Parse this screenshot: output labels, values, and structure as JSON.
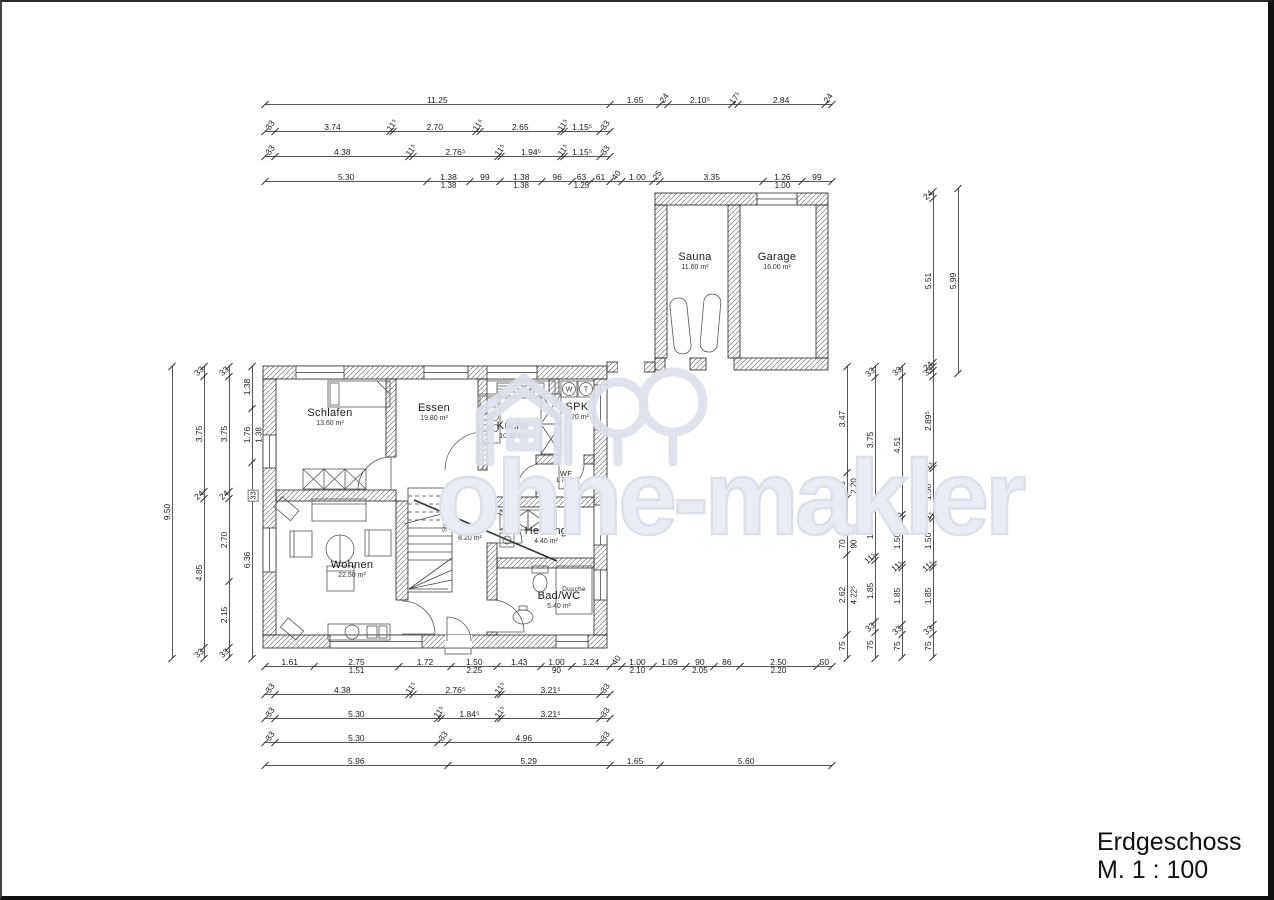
{
  "title": {
    "floor": "Erdgeschoss",
    "scale": "M. 1 : 100"
  },
  "watermark": {
    "text": "ohne-makler"
  },
  "plan": {
    "washer": "W",
    "dryer": "T",
    "stair_note": "Stg.",
    "wall_note": "33"
  },
  "colors": {
    "line": "#333333",
    "dim": "#1c1c1c",
    "watermark": "#e9ecf2"
  },
  "rooms": [
    {
      "name": "Sauna",
      "area": "11.60 m²"
    },
    {
      "name": "Garage",
      "area": "16.00 m²"
    },
    {
      "name": "Schlafen",
      "area": "13.60 m²"
    },
    {
      "name": "Essen",
      "area": "19.80 m²"
    },
    {
      "name": "Küche",
      "area": "10.90 m²"
    },
    {
      "name": "SPK",
      "area": "3.20 m²"
    },
    {
      "name": "WF",
      "area": "1.70 m²"
    },
    {
      "name": "Flur",
      "area": "8.20 m²"
    },
    {
      "name": "Wohnen",
      "area": "22.50 m²"
    },
    {
      "name": "Heizung",
      "area": "4.40 m²"
    },
    {
      "name": "Bad/WC",
      "area": "5.40 m²"
    },
    {
      "name": "Dusche",
      "area": ""
    }
  ],
  "dims": {
    "top": [
      [
        {
          "v": "11.25"
        },
        {
          "v": "1.65"
        },
        {
          "v": "24"
        },
        {
          "v": "2.10⁵"
        },
        {
          "v": "17⁵"
        },
        {
          "v": "2.84"
        },
        {
          "v": "24"
        }
      ],
      [
        {
          "v": "33"
        },
        {
          "v": "3.74"
        },
        {
          "v": "11⁵"
        },
        {
          "v": "2.70"
        },
        {
          "v": "11⁵"
        },
        {
          "v": "2.65"
        },
        {
          "v": "11⁵"
        },
        {
          "v": "1.15⁵"
        },
        {
          "v": "33"
        }
      ],
      [
        {
          "v": "33"
        },
        {
          "v": "4.38"
        },
        {
          "v": "11⁵"
        },
        {
          "v": "2.76⁵"
        },
        {
          "v": "11⁵"
        },
        {
          "v": "1.94⁵"
        },
        {
          "v": "11⁵"
        },
        {
          "v": "1.15⁵"
        },
        {
          "v": "33"
        }
      ],
      [
        {
          "v": "5.30"
        },
        {
          "v": "1.38",
          "sub": "1.38"
        },
        {
          "v": "99"
        },
        {
          "v": "1.38",
          "sub": "1.38"
        },
        {
          "v": "96"
        },
        {
          "v": "63",
          "sub": "1.25"
        },
        {
          "v": "61"
        },
        {
          "v": "40"
        },
        {
          "v": "1.00"
        },
        {
          "v": "25"
        },
        {
          "v": "3.35"
        },
        {
          "v": "1.26",
          "sub": "1.00"
        },
        {
          "v": "99"
        }
      ]
    ],
    "bottom": [
      [
        {
          "v": "1.61"
        },
        {
          "v": "2.75",
          "sub": "1.51"
        },
        {
          "v": "1.72"
        },
        {
          "v": "1.50",
          "sub": "2.25"
        },
        {
          "v": "1.43"
        },
        {
          "v": "1.00",
          "sub": "90"
        },
        {
          "v": "1.24"
        },
        {
          "v": "40"
        },
        {
          "v": "1.00",
          "sub": "2.10"
        },
        {
          "v": "1.09"
        },
        {
          "v": "90",
          "sub": "2.05"
        },
        {
          "v": "86"
        },
        {
          "v": "2.50",
          "sub": "2.20"
        },
        {
          "v": "50"
        }
      ],
      [
        {
          "v": "33"
        },
        {
          "v": "4.38"
        },
        {
          "v": "11⁵"
        },
        {
          "v": "2.76⁵"
        },
        {
          "v": "11⁵"
        },
        {
          "v": "3.21⁵"
        },
        {
          "v": "33"
        }
      ],
      [
        {
          "v": "33"
        },
        {
          "v": "5.30"
        },
        {
          "v": "11⁵"
        },
        {
          "v": "1.84⁵"
        },
        {
          "v": "11⁵"
        },
        {
          "v": "3.21⁵"
        },
        {
          "v": "33"
        }
      ],
      [
        {
          "v": "33"
        },
        {
          "v": "5.30"
        },
        {
          "v": "33"
        },
        {
          "v": "4.96"
        },
        {
          "v": "33"
        }
      ],
      [
        {
          "v": "5.96"
        },
        {
          "v": "5.29"
        },
        {
          "v": "1.65"
        },
        {
          "v": "5.60"
        }
      ]
    ],
    "left": [
      [
        {
          "v": "9.50"
        }
      ],
      [
        {
          "v": "33"
        },
        {
          "v": "3.75"
        },
        {
          "v": "24"
        },
        {
          "v": "4.85"
        },
        {
          "v": "33"
        }
      ],
      [
        {
          "v": "33"
        },
        {
          "v": "3.75"
        },
        {
          "v": "24"
        },
        {
          "v": "2.70"
        },
        {
          "v": "2.15"
        },
        {
          "v": "33"
        }
      ],
      [
        {
          "v": "1.38"
        },
        {
          "v": "1.76",
          "sub": "1.38"
        },
        {
          "v": "6.36"
        }
      ]
    ],
    "right": [
      [
        {
          "v": "3.47"
        },
        {
          "v": "85",
          "sub": "2.20"
        },
        {
          "v": "1.11"
        },
        {
          "v": "70",
          "sub": "90"
        },
        {
          "v": "2.62",
          "sub": "4.22⁵"
        },
        {
          "v": "75"
        }
      ],
      [
        {
          "v": "33"
        },
        {
          "v": "3.75"
        },
        {
          "v": "11⁵"
        },
        {
          "v": "1.50"
        },
        {
          "v": "11⁵"
        },
        {
          "v": "1.85"
        },
        {
          "v": "33"
        },
        {
          "v": "75"
        }
      ],
      [
        {
          "v": "33"
        },
        {
          "v": "4.51"
        },
        {
          "v": "11⁵"
        },
        {
          "v": "1.50"
        },
        {
          "v": "11⁵"
        },
        {
          "v": "1.85"
        },
        {
          "v": "33"
        },
        {
          "v": "75"
        }
      ],
      [
        {
          "v": "33"
        },
        {
          "v": "2.89⁵"
        },
        {
          "v": "11⁵"
        },
        {
          "v": "1.50"
        },
        {
          "v": "11⁵"
        },
        {
          "v": "1.50"
        },
        {
          "v": "11⁵"
        },
        {
          "v": "1.85"
        },
        {
          "v": "33"
        },
        {
          "v": "75"
        }
      ]
    ],
    "garage_right": [
      [
        {
          "v": "24"
        },
        {
          "v": "5.51"
        },
        {
          "v": "24"
        }
      ],
      [
        {
          "v": "5.99"
        }
      ]
    ]
  }
}
